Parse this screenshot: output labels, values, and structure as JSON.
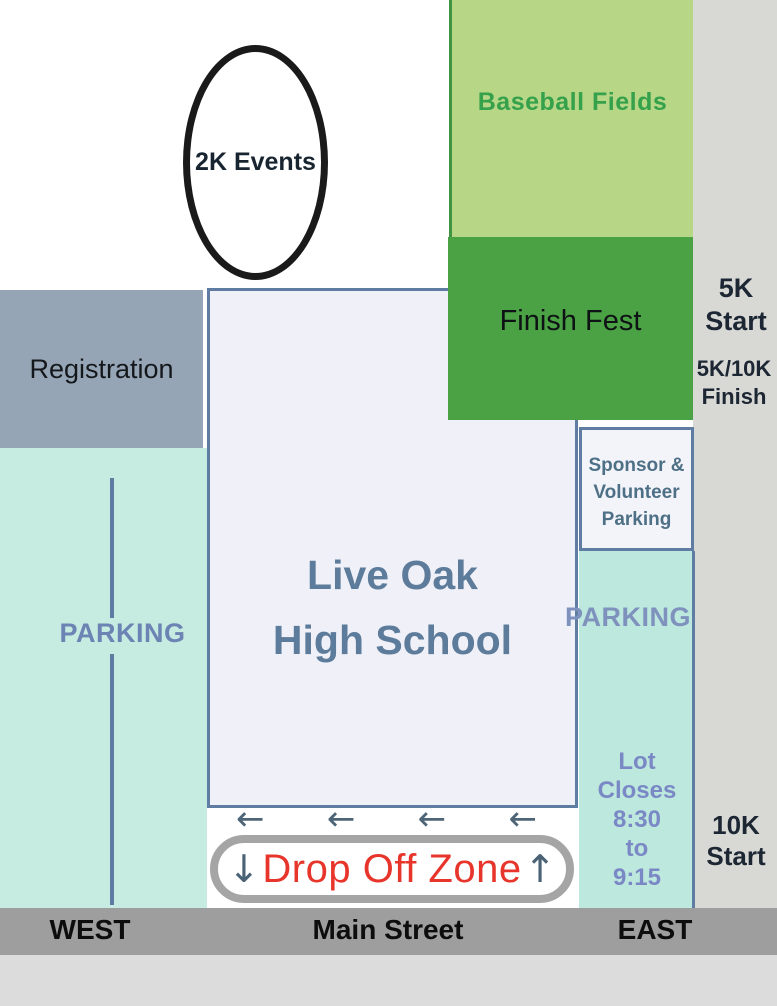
{
  "regions": {
    "events_2k": {
      "label": "2K Events"
    },
    "baseball_fields": {
      "label": "Baseball Fields"
    },
    "finish_fest": {
      "label": "Finish Fest"
    },
    "registration": {
      "label": "Registration"
    },
    "school": {
      "line1": "Live Oak",
      "line2": "High School"
    },
    "west_parking": {
      "label": "PARKING"
    },
    "east_parking": {
      "label": "PARKING"
    },
    "sponsor_parking": {
      "line1": "Sponsor &",
      "line2": "Volunteer",
      "line3": "Parking"
    },
    "lot_hours": {
      "line1": "Lot",
      "line2": "Closes",
      "line3": "8:30",
      "line4": "to",
      "line5": "9:15"
    },
    "drop_off": {
      "label": "Drop Off Zone"
    },
    "street": {
      "name": "Main Street",
      "west_label": "WEST",
      "east_label": "EAST"
    }
  },
  "course_labels": {
    "start_5k": {
      "line1": "5K",
      "line2": "Start"
    },
    "finish_5k10k": {
      "line1": "5K/10K",
      "line2": "Finish"
    },
    "start_10k": {
      "line1": "10K",
      "line2": "Start"
    }
  },
  "icons": {
    "left_arrow": "←",
    "down_arrow": "↓",
    "up_arrow": "↑"
  },
  "colors": {
    "baseball_green": "#b7d787",
    "finish_green": "#4aa244",
    "registration_gray_blue": "#96a5b5",
    "parking_teal_west": "#c6ebe0",
    "parking_teal_east": "#bde8dd",
    "school_fill": "#f0f1f8",
    "school_border": "#5f7da2",
    "parking_text_blue": "#6b84b3",
    "lot_hours_blue": "#7a89c5",
    "drop_off_red": "#e8352b",
    "street_gray": "#9e9e9e",
    "right_margin_gray": "#d8d8d5",
    "navy_text": "#1c2733"
  }
}
